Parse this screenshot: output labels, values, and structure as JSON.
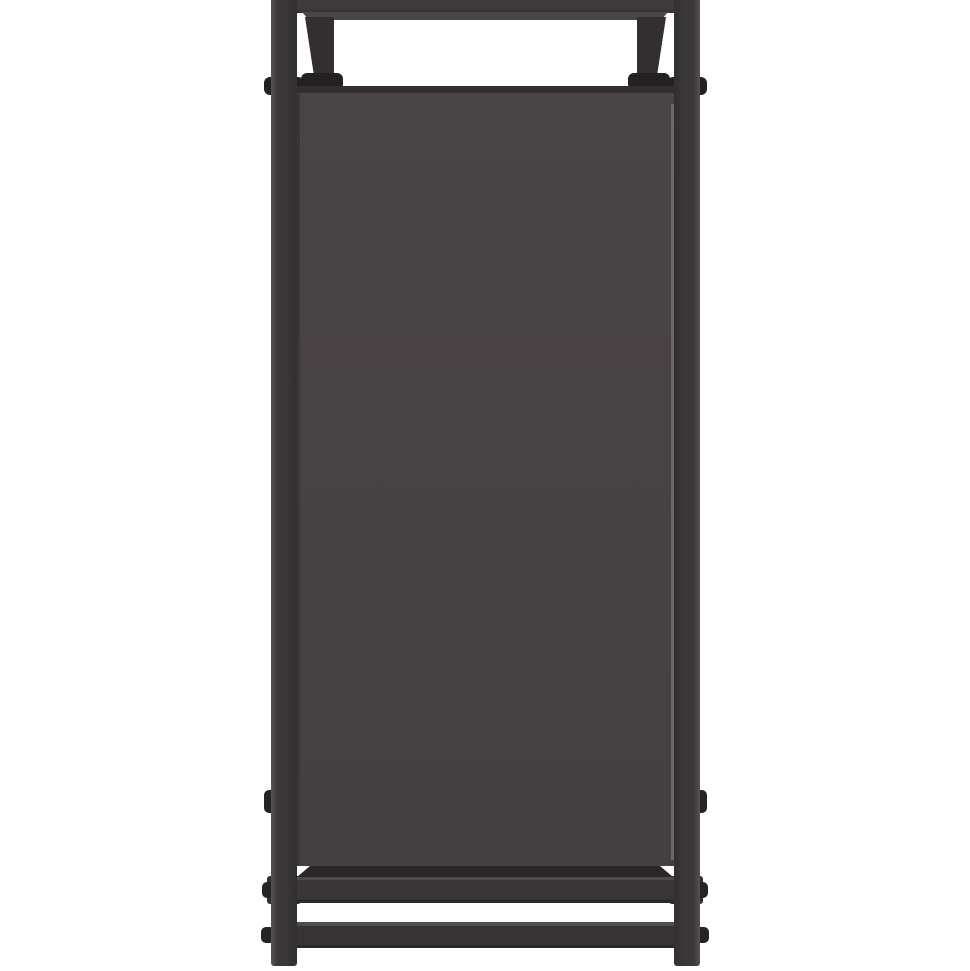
{
  "scene": {
    "description": "Studio product photograph on a white background: front/side view of a tall black metal rack. A dark warm-grey fabric panel is stretched between two square-tube steel posts. A narrow top shelf sits above the panel, attached with angled hanger brackets secured by clamp bolts. At the bottom are two horizontal cross rails joining the legs, with round bolt heads protruding from the outer faces of the posts. No text is visible anywhere in the image.",
    "object_type": "metal rack side frame with fabric panel",
    "background_color": "#ffffff"
  },
  "colors": {
    "background": "#ffffff",
    "shelf_top": "#3E3A3C",
    "shelf_lip": "#4A4647",
    "bracket": "#332F31",
    "clamp": "#242123",
    "panel_face": "#474244",
    "panel_top_edge": "#322E30",
    "panel_bottom_shadow": "#2A2728",
    "panel_seam_dark": "#3A3739",
    "panel_seam_light": "#8A8688",
    "post_highlight": "#575254",
    "post_mid": "#3B383A",
    "post_dark": "#322F31",
    "rail_face": "#3A3637",
    "rail_top_bevel": "#4E4A4C",
    "rail_bottom_edge": "#2B282A",
    "rail2_bevel": "#514D4F",
    "rail2_face": "#363334",
    "leg_block": "#332F31",
    "bolt": "#262324"
  }
}
